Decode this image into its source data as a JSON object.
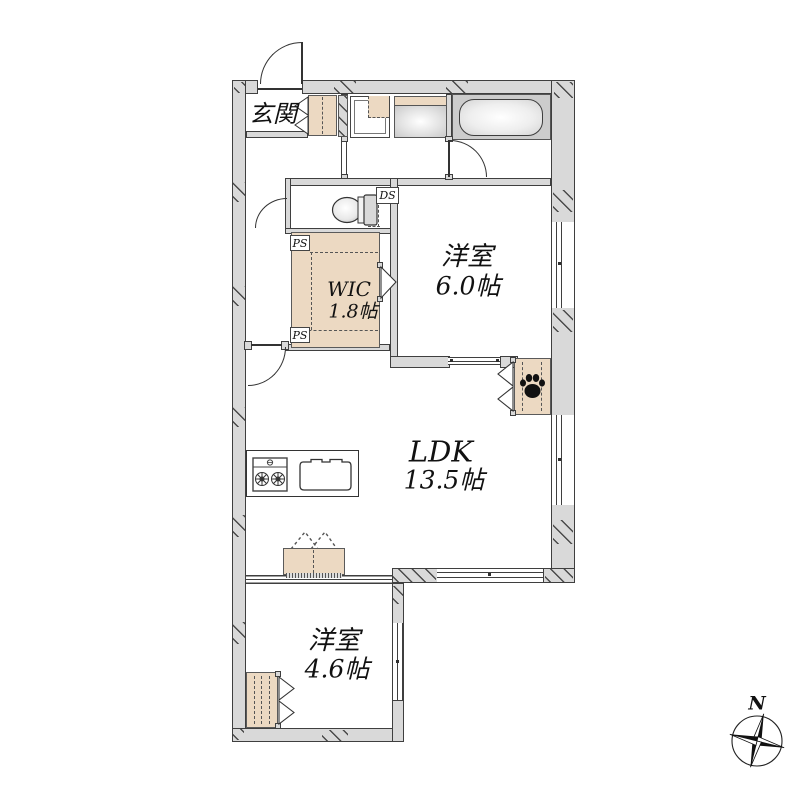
{
  "floorplan": {
    "rooms": {
      "entrance": {
        "label": "玄関"
      },
      "wic": {
        "name": "WIC",
        "size": "1.8帖"
      },
      "bedroom1": {
        "name": "洋室",
        "size": "6.0帖"
      },
      "ldk": {
        "name": "LDK",
        "size": "13.5帖"
      },
      "bedroom2": {
        "name": "洋室",
        "size": "4.6帖"
      }
    },
    "tags": {
      "ds": "DS",
      "ps_upper": "PS",
      "ps_lower": "PS"
    },
    "compass": {
      "north": "N"
    },
    "colors": {
      "wall_fill": "#d9d9d9",
      "wall_line": "#3f3f3f",
      "fixture_beige": "#ecd9c2",
      "bath_gray": "#cccccc",
      "paw_black": "#111111",
      "background": "#ffffff",
      "text": "#111111"
    },
    "icons": [
      "bathtub-icon",
      "washbasin-icon",
      "washing-machine-pan-icon",
      "toilet-icon",
      "stove-icon",
      "sink-icon",
      "paw-icon",
      "compass-icon"
    ]
  }
}
